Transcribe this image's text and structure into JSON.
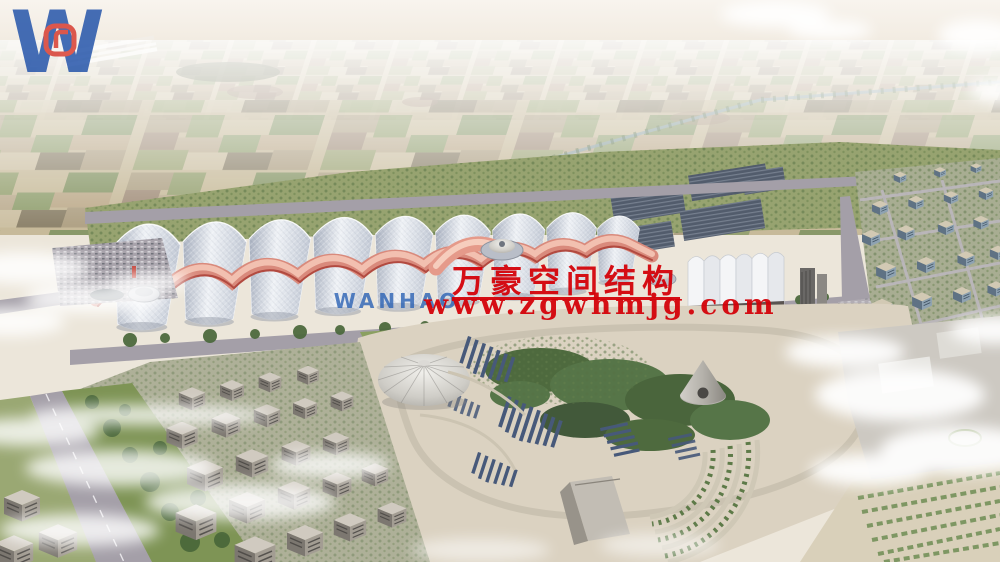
{
  "watermark": {
    "logo": {
      "monogram": "W",
      "wordmark": "WANHAO",
      "blue": "#1d4fa8",
      "red": "#d6362a"
    },
    "company_name_cn": "万豪空间结构",
    "website": "www.zgwhmjg.com",
    "text_red": "#d40008"
  },
  "palette": {
    "sky_haze": "#f5f0e8",
    "farmland": "#c7b996",
    "greenbelt": "#97a370",
    "trees": "#4e6a3e",
    "road": "#a49fa8",
    "hall_roof": "#d6dbe2",
    "hall_ridge_pink": "#e4a294",
    "hall_ridge_red": "#b5544a",
    "park_ground": "#dbd2c1",
    "solar_panel": "#4b5d7c",
    "building_facade": "#8ea2b2",
    "cloud": "#ffffff"
  }
}
